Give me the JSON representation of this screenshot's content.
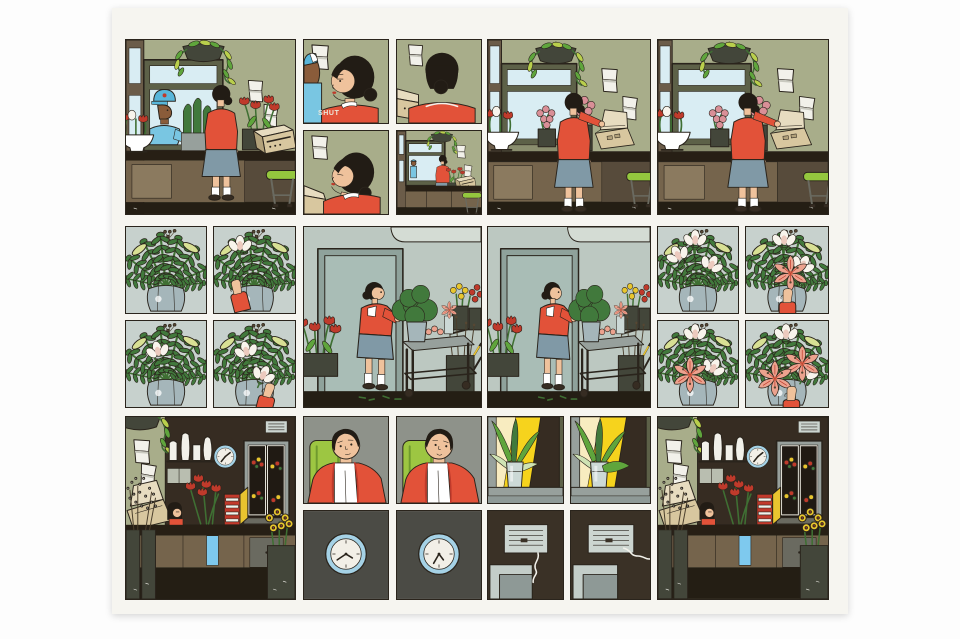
{
  "page": {
    "kind": "comic page",
    "grid": "three rows of panels",
    "sfx_note": "one sound effect"
  },
  "palette": {
    "line": "#2a241c",
    "pagebg": "#f6f5f0",
    "olive": "#a8ad8a",
    "oliveD": "#7c8264",
    "frame": "#5d6148",
    "frameL": "#8a8e6e",
    "brown": "#6b5c49",
    "sky": "#d9edf3",
    "planter": "#43463a",
    "leafG": "#5fa53c",
    "leafY": "#b9cf4c",
    "leafPale": "#cfe3b4",
    "paper": "#f2f1ea",
    "paperS": "#c9c9bf",
    "dwall": "#362c22",
    "counterT": "#271f15",
    "counterB": "#75644c",
    "counterL": "#8b7a5f",
    "counterD": "#574b3b",
    "tan": "#d8c79f",
    "tanL": "#e7dcc0",
    "tanS": "#b3a27b",
    "skin": "#efc29c",
    "skinD": "#8a5c3a",
    "hair": "#221c15",
    "red": "#e25239",
    "redD": "#bf3a2b",
    "skirt": "#8099a6",
    "white": "#ffffff",
    "cap": "#58b6da",
    "shirt": "#79c6e2",
    "floor": "#241e14",
    "stool": "#94c73e",
    "metal": "#97a09c",
    "metalL": "#b9beb0",
    "metalD": "#6a6a60",
    "cwall": "#bcc8c1",
    "cwallL": "#d4dcd4",
    "cdoor": "#a9bdb6",
    "cframe": "#8fa29b",
    "coolin": "#201a13",
    "fbg": "#c7d1cd",
    "fern": "#41793c",
    "fernD": "#2c5a2b",
    "pod": "#d8e094",
    "berry": "#564733",
    "vase": "#a5b6ba",
    "vaseG": "#ccd9d6",
    "lily": "#eca28e",
    "lilyD": "#d5694e",
    "mag": "#f8f4ec",
    "magP": "#eccabe",
    "pinkB": "#d98f97",
    "ring": "#a5d2e6",
    "face": "#f2efe7",
    "cardR": "#c23a2c",
    "cardY": "#e9c42f",
    "blue": "#7ec9ee",
    "daff": "#e8c62e",
    "chair": "#9dc642",
    "chairD": "#6f9a2e",
    "chbg": "#8e928a",
    "clkbg": "#4b4b45",
    "yel": "#f6d31d",
    "cream": "#f8ecc0",
    "vbg": "#3a3126",
    "vcard": "#ccd5d0",
    "grayL": "#c3cdc8",
    "grayM": "#8e9996",
    "stemG": "#3f6f33",
    "stemB": "#4a3e2c",
    "glass": "#e8e6dc"
  },
  "panels": {
    "r1p1": {
      "label": "Delivery man in a blue cap brings wrapped greens to the florist at the counter"
    },
    "r1p2a": {
      "label": "The florist glances back as the door shuts",
      "sfx": "SHUT"
    },
    "r1p2b": {
      "label": "The florist lowers her eyes by the register"
    },
    "r1p3a": {
      "label": "The florist from behind, facing the register"
    },
    "r1p3b": {
      "label": "Wide view of the florist alone at the counter"
    },
    "r1p4": {
      "label": "The florist opens the register by the window"
    },
    "r1p5": {
      "label": "The florist leans at the counter by the register"
    },
    "r2l1": {
      "label": "A fern arrangement in a glass vase"
    },
    "r2l2": {
      "label": "A hand places a white magnolia into the ferns"
    },
    "r2l3": {
      "label": "The magnolia sits among the ferns"
    },
    "r2l4": {
      "label": "A second magnolia is added"
    },
    "r2a": {
      "label": "The florist carries the arrangement to a cart in the cooler room"
    },
    "r2b": {
      "label": "The florist lifts the arrangement from the cart"
    },
    "r2r1": {
      "label": "Magnolias arranged among the ferns"
    },
    "r2r2": {
      "label": "A hand adds a pink lily"
    },
    "r2r3": {
      "label": "The lily rests among magnolias and ferns"
    },
    "r2r4": {
      "label": "A second lily completes the arrangement"
    },
    "r3l": {
      "label": "The shop: register, vases, wall clock, flower cooler and card rack"
    },
    "r3c1": {
      "label": "A woman dozes in a green chair"
    },
    "r3c2": {
      "label": "The woman stirs in the green chair"
    },
    "r3k1": {
      "label": "A wall clock"
    },
    "r3k2": {
      "label": "The wall clock, minutes later"
    },
    "r3w1": {
      "label": "A houseplant on a sunlit windowsill"
    },
    "r3w2": {
      "label": "The windowsill plant as the light shifts"
    },
    "r3v1": {
      "label": "A lined note on the wall with a hanging thread"
    },
    "r3v2": {
      "label": "The thread flutters in a draft"
    },
    "r3r": {
      "label": "The shop counter again, later"
    }
  }
}
